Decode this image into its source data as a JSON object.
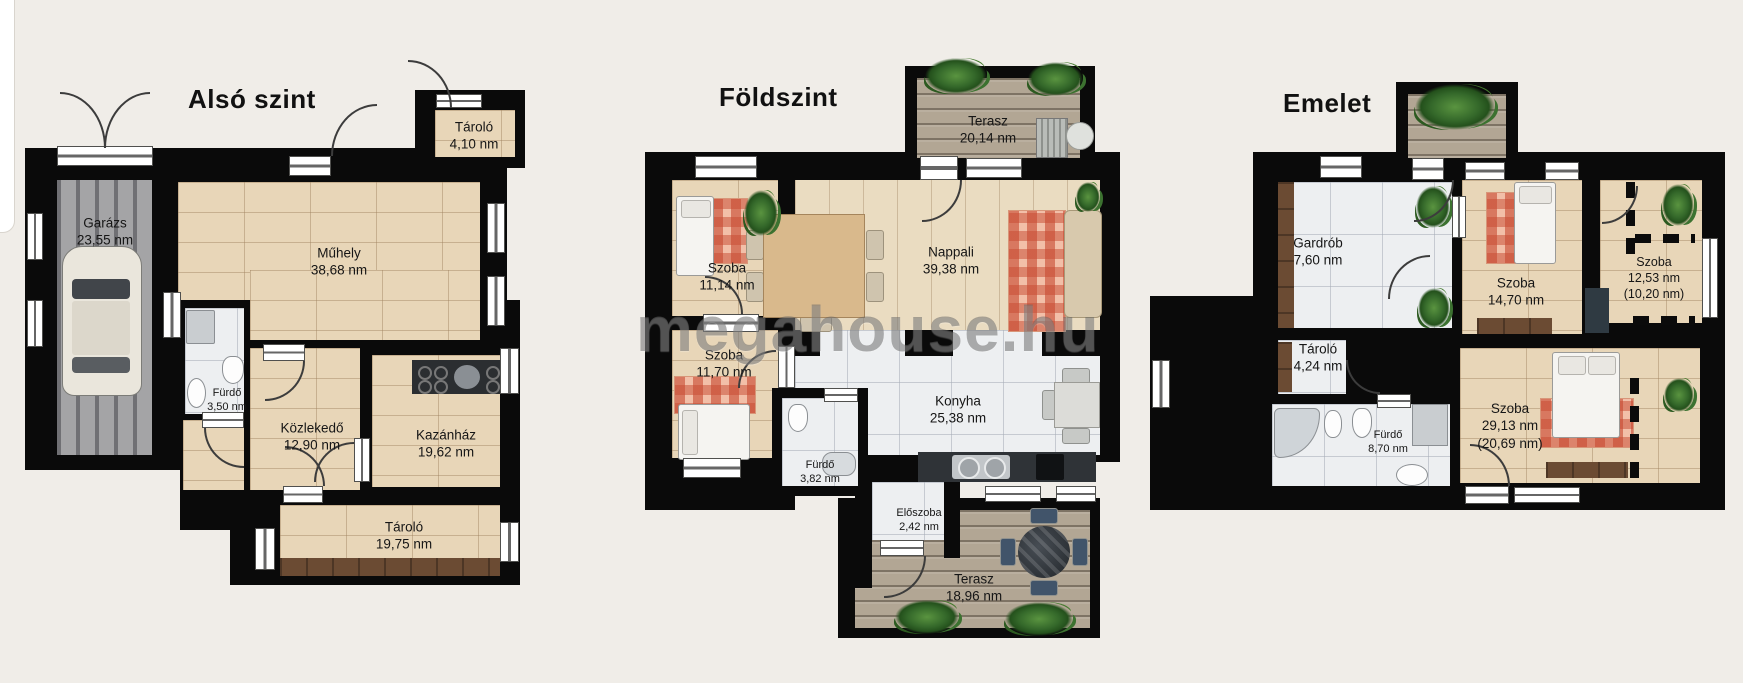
{
  "watermark": "megahouse.hu",
  "unit": "nm",
  "colors": {
    "background": "#f0ede8",
    "wall": "#0a0a0a",
    "wood_floor": "#e8d6b8",
    "marble_floor": "#edeff1",
    "deck": "#b2a694",
    "garage_floor": "#a4a4a6",
    "rug": "#e08a6d",
    "plant": "#34682a",
    "brown_wood": "#6b4b33"
  },
  "plans": [
    {
      "title": "Alsó szint",
      "rooms": [
        {
          "name": "Garázs",
          "area": "23,55 nm"
        },
        {
          "name": "Műhely",
          "area": "38,68 nm"
        },
        {
          "name": "Tároló",
          "area": "4,10 nm"
        },
        {
          "name": "Fürdő",
          "area": "3,50 nm"
        },
        {
          "name": "Közlekedő",
          "area": "12,90 nm"
        },
        {
          "name": "Kazánház",
          "area": "19,62 nm"
        },
        {
          "name": "Tároló",
          "area": "19,75 nm"
        }
      ]
    },
    {
      "title": "Földszint",
      "rooms": [
        {
          "name": "Terasz",
          "area": "20,14 nm"
        },
        {
          "name": "Szoba",
          "area": "11,14 nm"
        },
        {
          "name": "Nappali",
          "area": "39,38 nm"
        },
        {
          "name": "Szoba",
          "area": "11,70 nm"
        },
        {
          "name": "Fürdő",
          "area": "3,82 nm"
        },
        {
          "name": "Konyha",
          "area": "25,38 nm"
        },
        {
          "name": "Előszoba",
          "area": "2,42 nm"
        },
        {
          "name": "Terasz",
          "area": "18,96 nm"
        }
      ]
    },
    {
      "title": "Emelet",
      "rooms": [
        {
          "name": "Gardrób",
          "area": "7,60 nm"
        },
        {
          "name": "Szoba",
          "area": "14,70 nm"
        },
        {
          "name": "Szoba",
          "area": "12,53 nm",
          "area2": "(10,20 nm)"
        },
        {
          "name": "Tároló",
          "area": "4,24 nm"
        },
        {
          "name": "Fürdő",
          "area": "8,70 nm"
        },
        {
          "name": "Szoba",
          "area": "29,13 nm",
          "area2": "(20,69 nm)"
        }
      ]
    }
  ]
}
